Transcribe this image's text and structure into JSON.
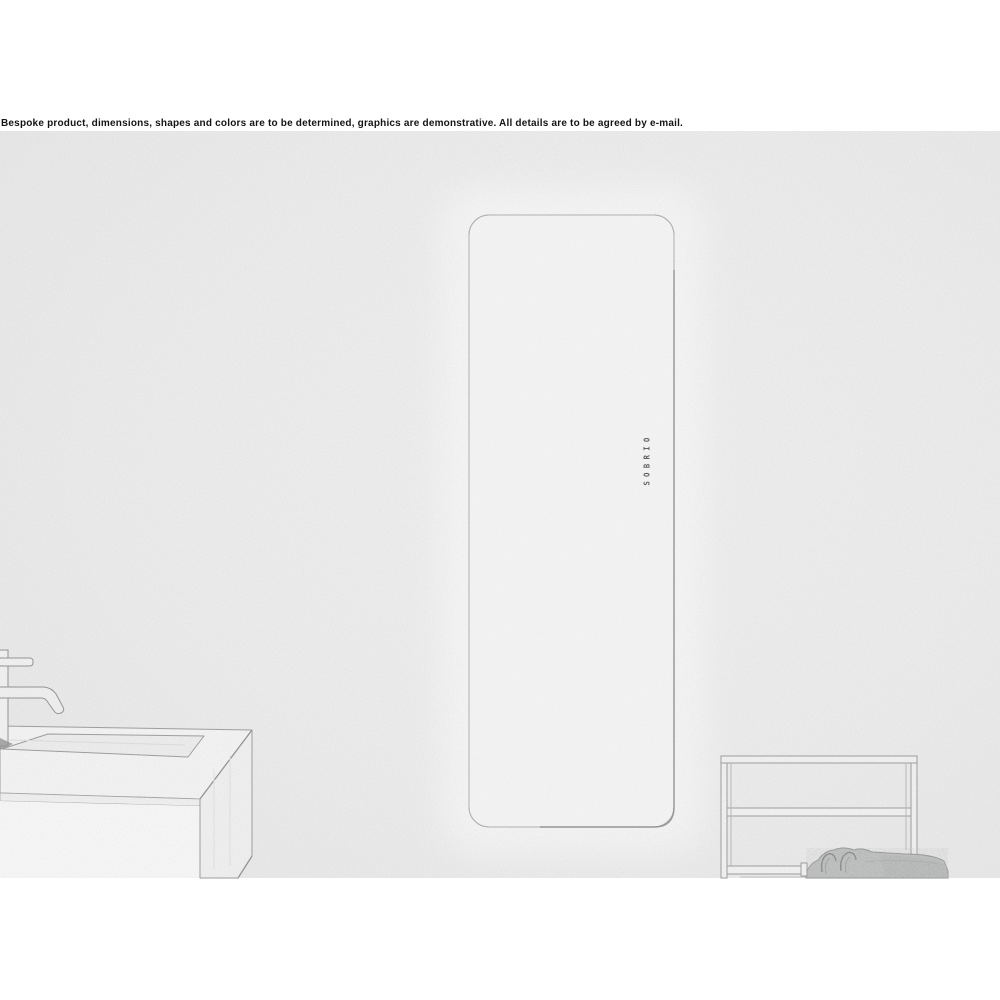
{
  "disclaimer_text": "Bespoke product, dimensions, shapes and colors are to be determined, graphics are demonstrative. All details are to be agreed by e-mail.",
  "radiator": {
    "logo_vertical_text": "SOBRIO"
  },
  "colors": {
    "page_background": "#ffffff",
    "photo_background": "#efefef",
    "line_art": "#9a9a9a",
    "panel_fill": "#f5f5f5",
    "panel_edge_shadow": "#8f8f8f",
    "counter_fill": "#f6f6f6",
    "cabinet_fill": "#fafafa",
    "towel_fill": "#bcbfbe",
    "disclaimer_color": "#141414",
    "logo_color": "#4a4a4a"
  }
}
